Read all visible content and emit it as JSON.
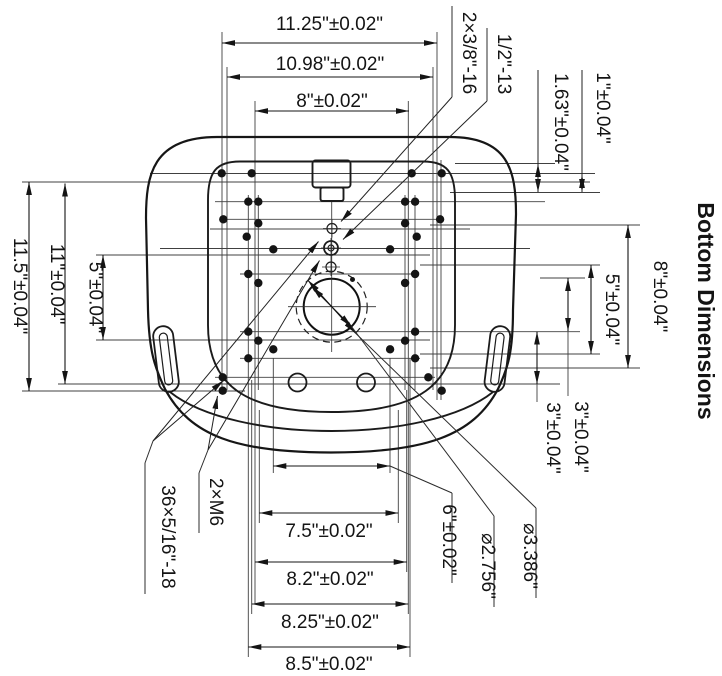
{
  "title": "Bottom Dimensions",
  "colors": {
    "line": "#161616",
    "construction": "#404040",
    "background": "#ffffff"
  },
  "dimensions": {
    "top": [
      "11.25\"±0.02\"",
      "10.98\"±0.02\"",
      "8\"±0.02\""
    ],
    "bottom": [
      "7.5\"±0.02\"",
      "8.2\"±0.02\"",
      "8.25\"±0.02\"",
      "8.5\"±0.02\""
    ],
    "left": [
      "11.5\"±0.04\"",
      "11\"±0.04\"",
      "5\"±0.04\""
    ],
    "right": [
      "1\"±0.04\"",
      "1.63\"±0.04\"",
      "8\"±0.04\"",
      "5\"±0.04\"",
      "3\"±0.04\"",
      "3\"±0.04\""
    ]
  },
  "callouts": {
    "top_right": [
      "2×3/8\"-16",
      "1/2\"-13"
    ],
    "bottom_left": [
      "36×5/16\"-18",
      "2×M6"
    ],
    "bottom_right": [
      "6\"±0.02\"",
      "⌀2.756\"",
      "⌀3.386\""
    ]
  }
}
